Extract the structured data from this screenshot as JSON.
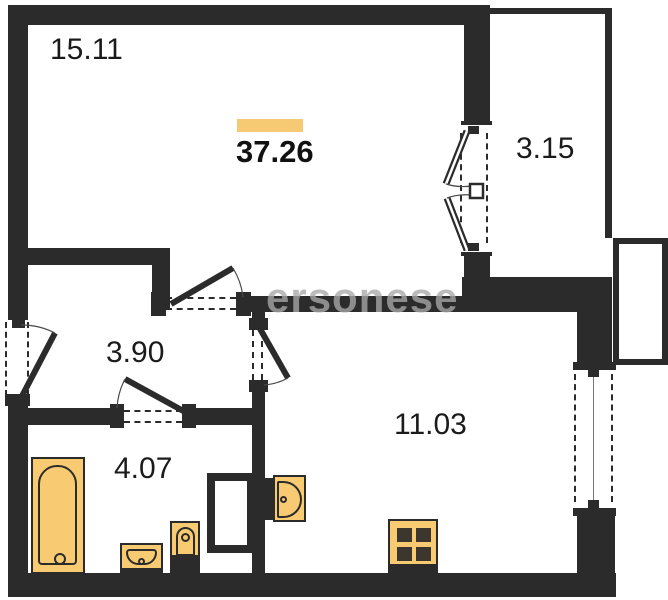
{
  "floorplan": {
    "total_area": "37.26",
    "watermark_text": "ersonese",
    "rooms": {
      "living": {
        "area": "15.11"
      },
      "balcony": {
        "area": "3.15"
      },
      "hallway": {
        "area": "3.90"
      },
      "bathroom": {
        "area": "4.07"
      },
      "kitchen_living": {
        "area": "11.03"
      }
    },
    "colors": {
      "wall": "#2b2b2b",
      "fixture_fill": "#f8cb73",
      "fixture_outline": "#2b2b2b",
      "accent_bar": "#f6ca73",
      "watermark": "#a8a8a8"
    }
  }
}
